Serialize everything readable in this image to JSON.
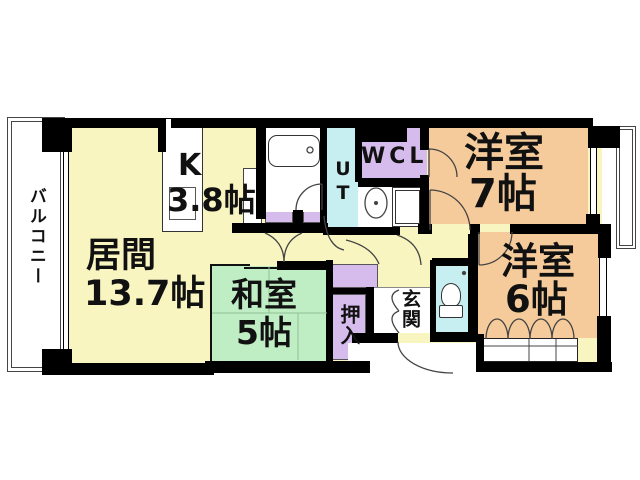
{
  "floorplan": {
    "rooms": {
      "living": {
        "label": "居間",
        "area": "13.7帖"
      },
      "kitchen": {
        "label": "K",
        "area": "3.8帖"
      },
      "japanese_room": {
        "label": "和室",
        "area": "5帖"
      },
      "western_room_7": {
        "label": "洋室",
        "area": "7帖"
      },
      "western_room_6": {
        "label": "洋室",
        "area": "6帖"
      },
      "balcony": {
        "label": "バルコニー"
      },
      "entrance": {
        "label": "玄関"
      },
      "oshiire_closet": {
        "label": "押入"
      },
      "walk_in_closet": {
        "label": "WCL"
      },
      "utility": {
        "label": "UT"
      }
    },
    "colors": {
      "living_yellow": "#F8F5C1",
      "tatami_green": "#C0EEC4",
      "western_orange": "#F6CB9B",
      "closet_purple": "#D6BCEC",
      "wet_cyan": "#C7EFF2",
      "wall_black": "#000000"
    }
  }
}
